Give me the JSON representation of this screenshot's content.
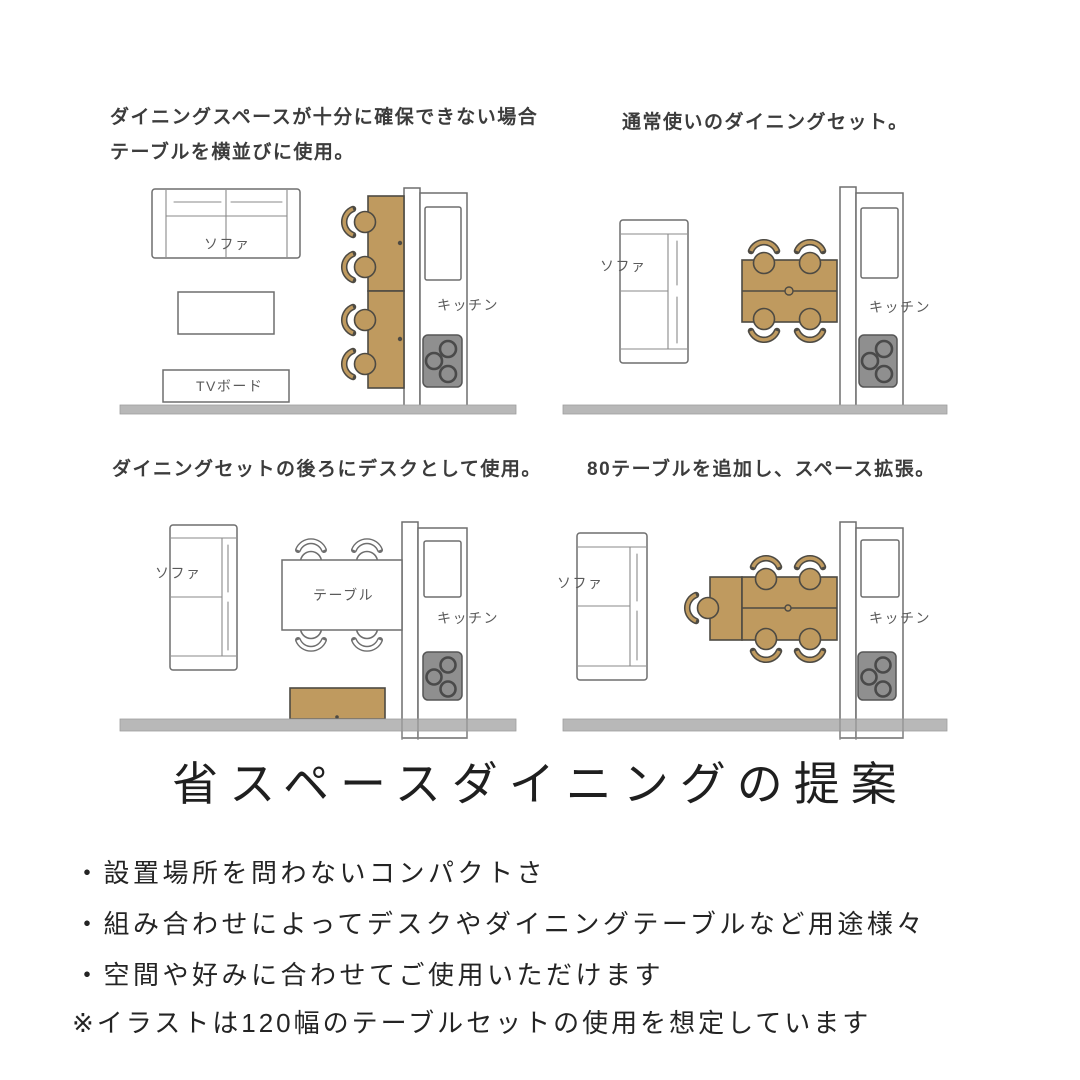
{
  "title": "省スペースダイニングの提案",
  "quadrants": [
    {
      "caption_line1": "ダイニングスペースが十分に確保できない場合",
      "caption_line2": "テーブルを横並びに使用。",
      "labels": {
        "sofa": "ソファ",
        "tv_board": "TVボード",
        "kitchen": "キッチン"
      }
    },
    {
      "caption": "通常使いのダイニングセット。",
      "labels": {
        "sofa": "ソファ",
        "kitchen": "キッチン"
      }
    },
    {
      "caption": "ダイニングセットの後ろにデスクとして使用。",
      "labels": {
        "sofa": "ソファ",
        "table": "テーブル",
        "kitchen": "キッチン"
      }
    },
    {
      "caption": "80テーブルを追加し、スペース拡張。",
      "labels": {
        "sofa": "ソファ",
        "kitchen": "キッチン"
      }
    }
  ],
  "bullets": [
    "・設置場所を問わないコンパクトさ",
    "・組み合わせによってデスクやダイニングテーブルなど用途様々",
    "・空間や好みに合わせてご使用いただけます"
  ],
  "note": "※イラストは120幅のテーブルセットの使用を想定しています",
  "colors": {
    "wood": "#bf9a5f",
    "wood_outline": "#4d4a43",
    "line_gray": "#6e6e6e",
    "stove_gray": "#8f8f8f",
    "floor_gray": "#b8b8b8",
    "caption_text": "#3c3c3c",
    "label_text": "#5a5a5a",
    "title_text": "#1f1f1f"
  }
}
